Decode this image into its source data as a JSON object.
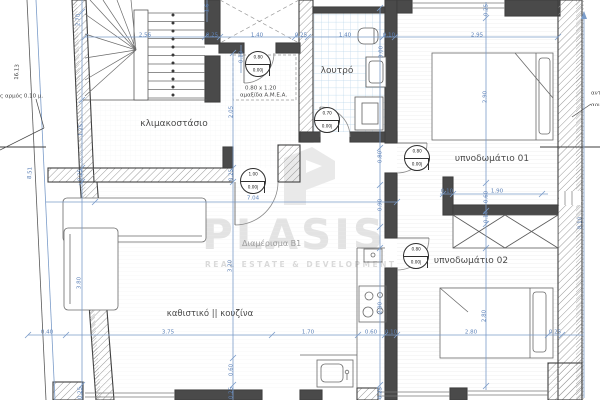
{
  "rooms": {
    "stairwell": "κλιμακοστάσιο",
    "bathroom": "λουτρό",
    "bedroom1": "υπνοδωμάτιο 01",
    "bedroom2": "υπνοδωμάτιο 02",
    "living_kitchen": "καθιστικό || κουζίνα"
  },
  "apartment_label": "Διαμέρισμα Β1",
  "watermark": {
    "brand": "PLASIS",
    "tagline": "REAL ESTATE & DEVELOPMENT"
  },
  "notes": {
    "amea_line1": "0.80 x 1.20",
    "amea_line2": "αμαξίδα Α.Μ.Ε.Α.",
    "joint_left": "ς αρμός 0.10 μ.",
    "joint_right_1": "αντισ",
    "joint_right_2": "αρμός"
  },
  "doors": [
    {
      "id": "elevator-lobby",
      "w": "0.80",
      "sill": "0.00",
      "head": "2.20",
      "cx": 258,
      "cy": 64
    },
    {
      "id": "entrance",
      "w": "1.00",
      "sill": "0.00",
      "head": "2.20",
      "cx": 253,
      "cy": 181
    },
    {
      "id": "bathroom",
      "w": "0.70",
      "sill": "0.00",
      "head": "2.20",
      "cx": 327,
      "cy": 120
    },
    {
      "id": "bedroom-01",
      "w": "0.80",
      "sill": "0.00",
      "head": "2.20",
      "cx": 417,
      "cy": 158
    },
    {
      "id": "bedroom-02",
      "w": "0.80",
      "sill": "0.00",
      "head": "2.20",
      "cx": 416,
      "cy": 256
    }
  ],
  "dimensions": [
    {
      "t": "2.56",
      "x": 145,
      "y": 35
    },
    {
      "t": "0.25",
      "x": 212,
      "y": 35
    },
    {
      "t": "1.40",
      "x": 257,
      "y": 35
    },
    {
      "t": "0.25",
      "x": 301,
      "y": 35
    },
    {
      "t": "1.40",
      "x": 345,
      "y": 35
    },
    {
      "t": "0.10",
      "x": 389,
      "y": 35
    },
    {
      "t": "2.95",
      "x": 477,
      "y": 35
    },
    {
      "t": "7.04",
      "x": 253,
      "y": 198
    },
    {
      "t": "0.40",
      "x": 47,
      "y": 332
    },
    {
      "t": "3.75",
      "x": 168,
      "y": 332
    },
    {
      "t": "1.70",
      "x": 308,
      "y": 332
    },
    {
      "t": "0.60",
      "x": 371,
      "y": 332
    },
    {
      "t": "0.10",
      "x": 391,
      "y": 332
    },
    {
      "t": "2.80",
      "x": 471,
      "y": 332
    },
    {
      "t": "0.25",
      "x": 555,
      "y": 332
    },
    {
      "t": "0.10",
      "x": 447,
      "y": 191
    },
    {
      "t": "1.90",
      "x": 497,
      "y": 191
    },
    {
      "t": "2.70",
      "x": 78,
      "y": 20,
      "r": -90
    },
    {
      "t": "1.25",
      "x": 81,
      "y": 130,
      "r": -90
    },
    {
      "t": "0.25",
      "x": 80,
      "y": 175,
      "r": -90
    },
    {
      "t": "3.80",
      "x": 79,
      "y": 283,
      "r": -90
    },
    {
      "t": "0.25",
      "x": 80,
      "y": 393,
      "r": -90
    },
    {
      "t": "2.05",
      "x": 231,
      "y": 112,
      "r": -90
    },
    {
      "t": "0.25",
      "x": 231,
      "y": 175,
      "r": -90
    },
    {
      "t": "3.20",
      "x": 230,
      "y": 266,
      "r": -90
    },
    {
      "t": "0.60",
      "x": 231,
      "y": 370,
      "r": -90
    },
    {
      "t": "0.25",
      "x": 231,
      "y": 393,
      "r": -90
    },
    {
      "t": "0.10",
      "x": 241,
      "y": 57,
      "r": -90
    },
    {
      "t": "1.6",
      "x": 207,
      "y": 8,
      "r": -90
    },
    {
      "t": "3.00",
      "x": 381,
      "y": 52,
      "r": -90
    },
    {
      "t": "0.80",
      "x": 380,
      "y": 157,
      "r": -90
    },
    {
      "t": "0.90",
      "x": 380,
      "y": 205,
      "r": -90
    },
    {
      "t": "2.90",
      "x": 380,
      "y": 308,
      "r": -90
    },
    {
      "t": "0.25",
      "x": 380,
      "y": 393,
      "r": -90
    },
    {
      "t": "0.25",
      "x": 486,
      "y": 10,
      "r": -90
    },
    {
      "t": "2.90",
      "x": 485,
      "y": 97,
      "r": -90
    },
    {
      "t": "0.60",
      "x": 486,
      "y": 197,
      "r": -90
    },
    {
      "t": "0.10",
      "x": 486,
      "y": 217,
      "r": -90
    },
    {
      "t": "2.80",
      "x": 484,
      "y": 316,
      "r": -90
    },
    {
      "t": "8.10",
      "x": 580,
      "y": 223,
      "r": -90
    },
    {
      "t": "16.13",
      "x": 17,
      "y": 72,
      "r": -87,
      "cls": "dark"
    },
    {
      "t": "8.51",
      "x": 30,
      "y": 173,
      "r": -87
    }
  ],
  "colors": {
    "dim_blue": "#5d82b8",
    "wall": "#4a4a4a",
    "tile": "#bcd7ea",
    "watermark": "#e3e3e3"
  }
}
